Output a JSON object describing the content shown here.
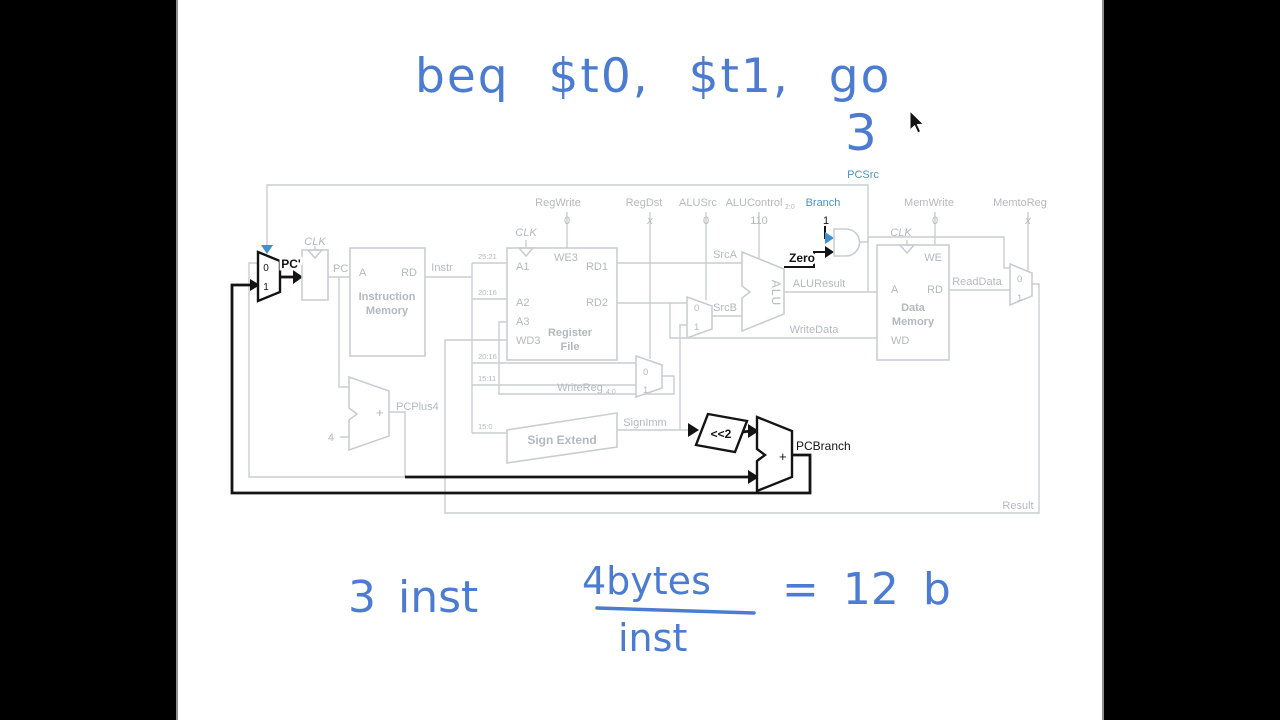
{
  "handwriting": {
    "color": "#4b7cd1",
    "instruction": "beq $t0, $t1, go",
    "count": "3",
    "calc": {
      "left": "3 inst",
      "numerator": "4bytes",
      "denominator": "inst",
      "result": "= 12 b"
    }
  },
  "diagram": {
    "colors": {
      "faded_line": "#c9cdd2",
      "faded_text": "#b4b9be",
      "highlight": "#141414",
      "control_blue": "#4a94c2"
    },
    "controls": [
      {
        "name": "RegWrite",
        "value": "0"
      },
      {
        "name": "RegDst",
        "value": "x"
      },
      {
        "name": "ALUSrc",
        "value": "0"
      },
      {
        "name": "ALUControl",
        "sub": "2:0",
        "value": "110"
      },
      {
        "name": "Branch",
        "value": "1"
      },
      {
        "name": "MemWrite",
        "value": "0"
      },
      {
        "name": "MemtoReg",
        "value": "x"
      }
    ],
    "signals": {
      "pcsrc": "PCSrc",
      "pc_prime": "PC'",
      "pc": "PC",
      "instr": "Instr",
      "srca": "SrcA",
      "srcb": "SrcB",
      "zero": "Zero",
      "aluresult": "ALUResult",
      "writedata": "WriteData",
      "readdata": "ReadData",
      "signimm": "SignImm",
      "writereg": "WriteReg",
      "writereg_sub": "4:0",
      "pcplus4": "PCPlus4",
      "pcbranch": "PCBranch",
      "result": "Result",
      "four": "4",
      "plus": "+",
      "shift": "<<2",
      "clk": "CLK"
    },
    "slices": [
      "25:21",
      "20:16",
      "20:16",
      "15:11",
      "15:0"
    ],
    "mux": {
      "zero": "0",
      "one": "1"
    },
    "blocks": {
      "imem": {
        "a": "A",
        "rd": "RD",
        "line1": "Instruction",
        "line2": "Memory"
      },
      "regfile": {
        "we3": "WE3",
        "a1": "A1",
        "rd1": "RD1",
        "a2": "A2",
        "rd2": "RD2",
        "a3": "A3",
        "wd3": "WD3",
        "line1": "Register",
        "line2": "File"
      },
      "dmem": {
        "we": "WE",
        "a": "A",
        "rd": "RD",
        "wd": "WD",
        "line1": "Data",
        "line2": "Memory"
      },
      "signext": "Sign Extend",
      "alu": "ALU"
    }
  }
}
